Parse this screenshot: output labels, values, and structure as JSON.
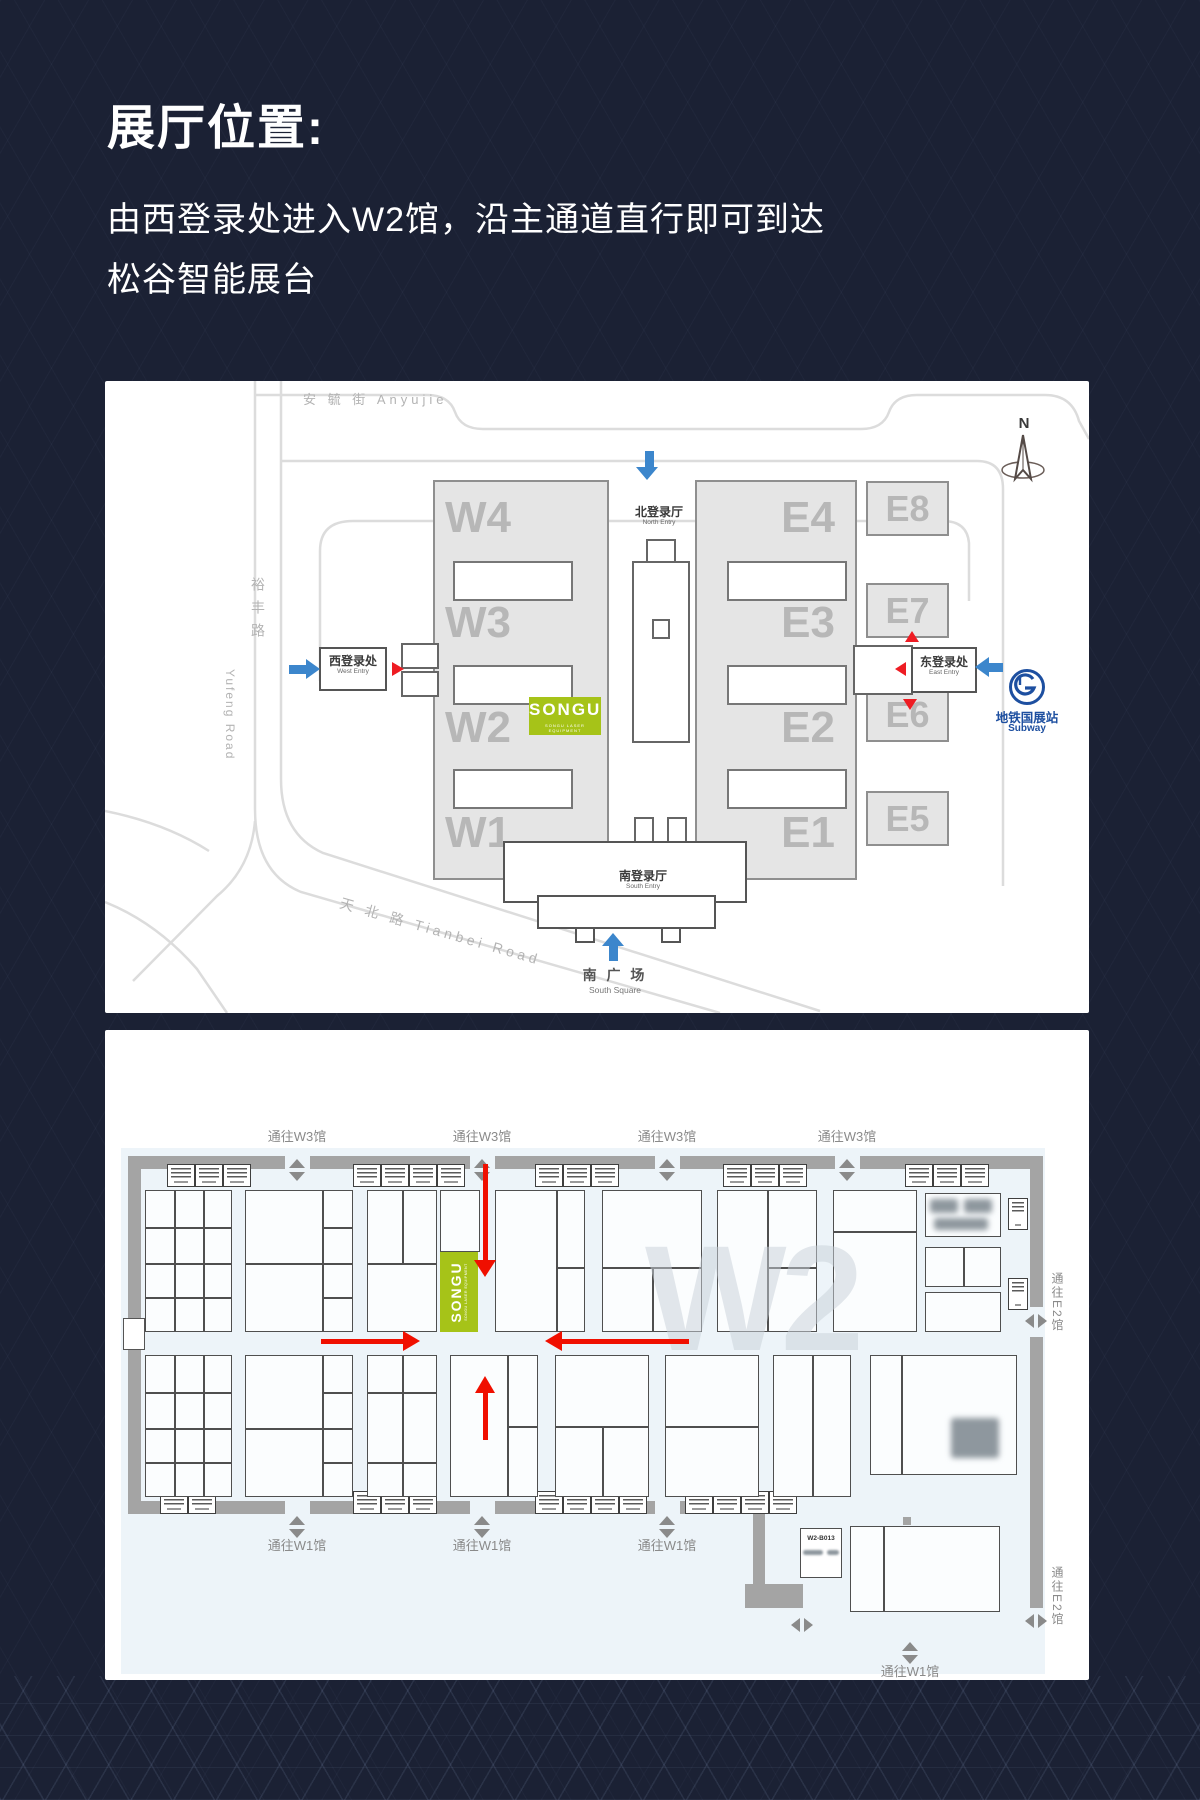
{
  "header": {
    "title": "展厅位置:",
    "line1": "由西登录处进入W2馆，沿主通道直行即可到达",
    "line2": "松谷智能展台"
  },
  "overview": {
    "roads": {
      "anyujie": "安 毓 街 Anyujie",
      "yufeng_cn": "裕丰路",
      "yufeng_en": "Yufeng Road",
      "tianbei": "天 北 路 Tianbei Road"
    },
    "compass_n": "N",
    "halls_west": [
      "W4",
      "W3",
      "W2",
      "W1"
    ],
    "halls_east": [
      "E4",
      "E3",
      "E2",
      "E1"
    ],
    "halls_far_east": [
      "E8",
      "E7",
      "E6",
      "E5"
    ],
    "north_entry_cn": "北登录厅",
    "north_entry_en": "North Entry",
    "south_entry_cn": "南登录厅",
    "south_entry_en": "South Entry",
    "west_entry_cn": "西登录处",
    "west_entry_en": "West Entry",
    "east_entry_cn": "东登录处",
    "east_entry_en": "East Entry",
    "south_square_cn": "南 广 场",
    "south_square_en": "South Square",
    "subway_cn": "地铁国展站",
    "subway_en": "Subway",
    "logo_text": "SONGU",
    "logo_tagline": "SONGU LASER EQUIPMENT"
  },
  "floor": {
    "watermark": "W2",
    "to_w3": "通往W3馆",
    "to_w1": "通往W1馆",
    "to_e2": "通往E2馆",
    "annex_booth": "W2-B013",
    "logo_text": "SONGU",
    "logo_tagline": "SONGU LASER EQUIPMENT"
  },
  "colors": {
    "accent_green": "#a6c318",
    "arrow_blue": "#3c86cc",
    "arrow_red": "#ee1c23",
    "subway_blue": "#1d4fa0"
  }
}
